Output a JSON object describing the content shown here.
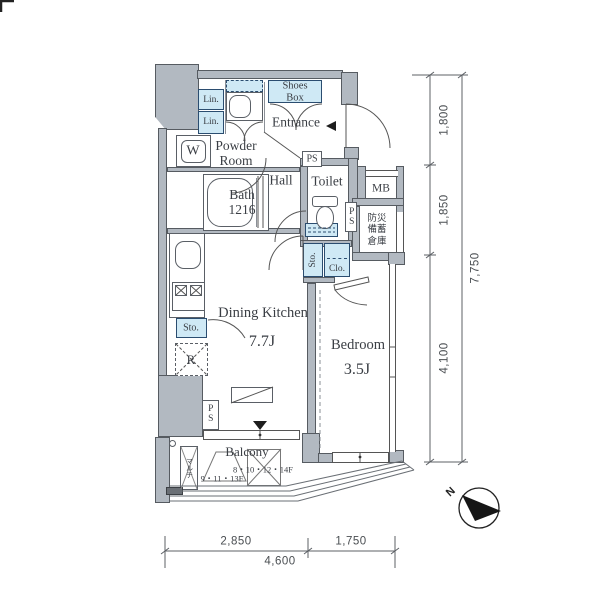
{
  "rooms": {
    "shoes_box": [
      "Shoes",
      "Box"
    ],
    "entrance": "Entrance",
    "lin": "Lin.",
    "powder_room": [
      "Powder",
      "Room"
    ],
    "washer": "W",
    "hall": "Hall",
    "bath": [
      "Bath",
      "1216"
    ],
    "toilet": "Toilet",
    "ps": "PS",
    "mb": "MB",
    "disaster_storage": [
      "防災",
      "備蓄",
      "倉庫"
    ],
    "sto": "Sto.",
    "clo": "Clo.",
    "dining_kitchen": "Dining Kitchen",
    "dining_kitchen_size": "7.7J",
    "bedroom": "Bedroom",
    "bedroom_size": "3.5J",
    "fridge": "R",
    "multi_media": "マルチ",
    "balcony": "Balcony",
    "balcony_floors_a": "9・11・13F",
    "balcony_floors_b": "8・10・12・14F"
  },
  "dimensions": {
    "right_segments": [
      "1,800",
      "1,850",
      "4,100"
    ],
    "right_total": "7,750",
    "bottom_segments": [
      "2,850",
      "1,750"
    ],
    "bottom_total": "4,600"
  },
  "compass": {
    "north": "N"
  },
  "colors": {
    "wall_fill": "#b2b9c1",
    "wall_line": "#565b61",
    "fixture_fill": "#cfe9f5",
    "fixture_border": "#2b4d70",
    "ink": "#3a3e44"
  }
}
